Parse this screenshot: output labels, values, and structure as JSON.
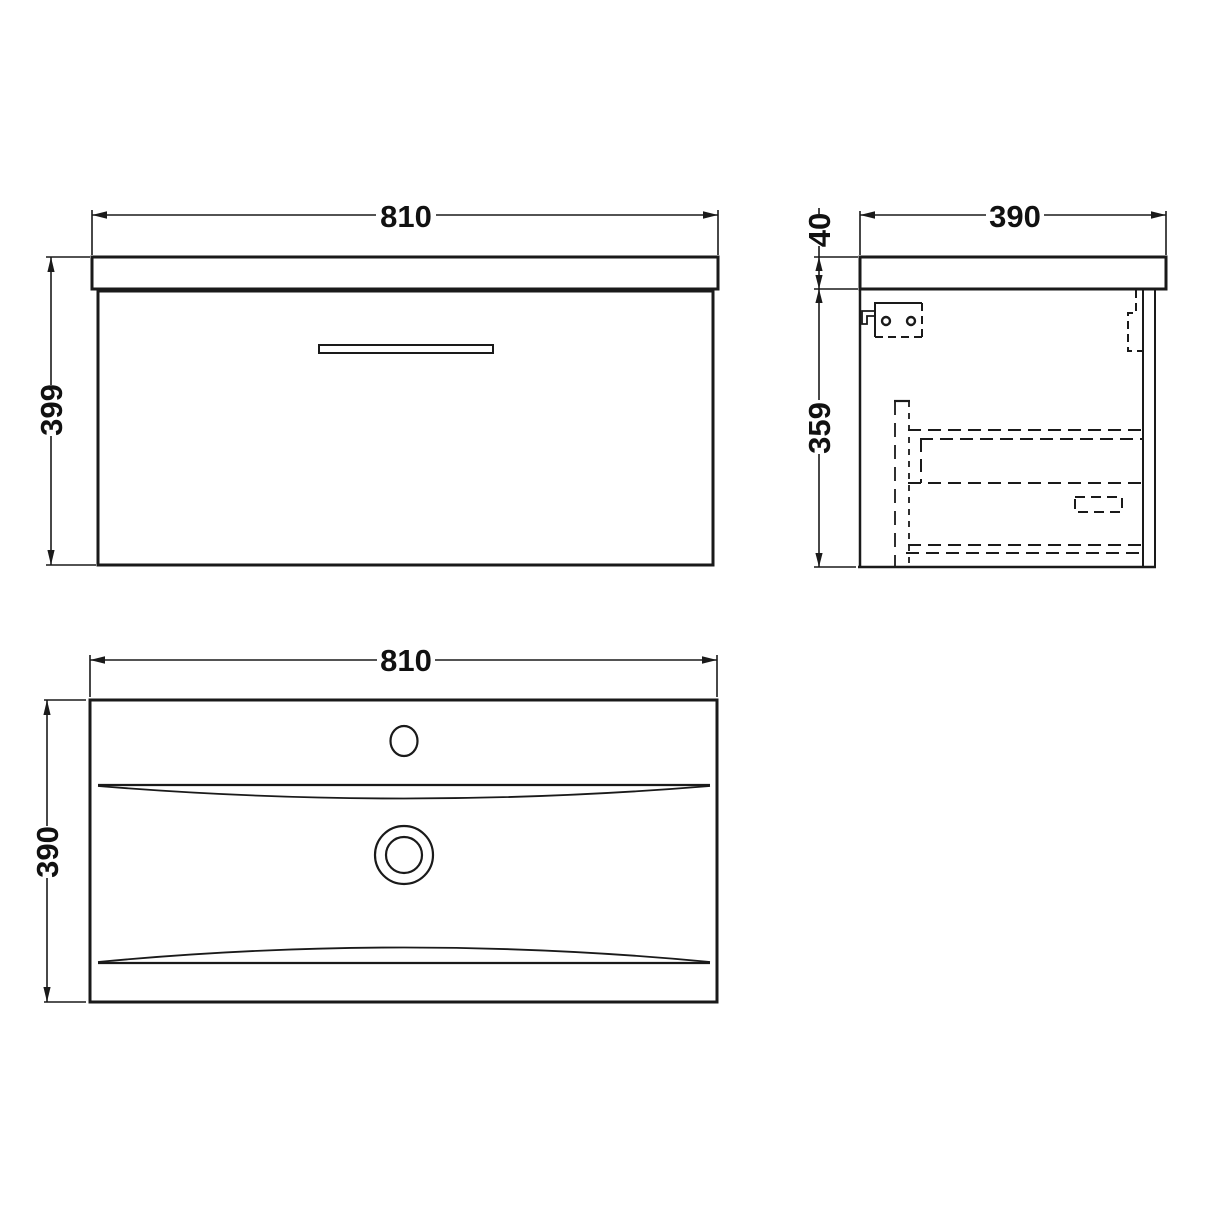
{
  "drawing": {
    "type": "technical-dimension-drawing",
    "subject": "wall-hung vanity unit with basin",
    "colors": {
      "background": "#ffffff",
      "line": "#1a1a1a",
      "text": "#111111"
    },
    "views": {
      "front": {
        "label": "front-elevation",
        "width_mm": "810",
        "height_mm": "399"
      },
      "side": {
        "label": "side-elevation",
        "depth_mm": "390",
        "worktop_thickness_mm": "40",
        "cabinet_height_mm": "359"
      },
      "plan": {
        "label": "basin-plan",
        "width_mm": "810",
        "depth_mm": "390"
      }
    }
  }
}
